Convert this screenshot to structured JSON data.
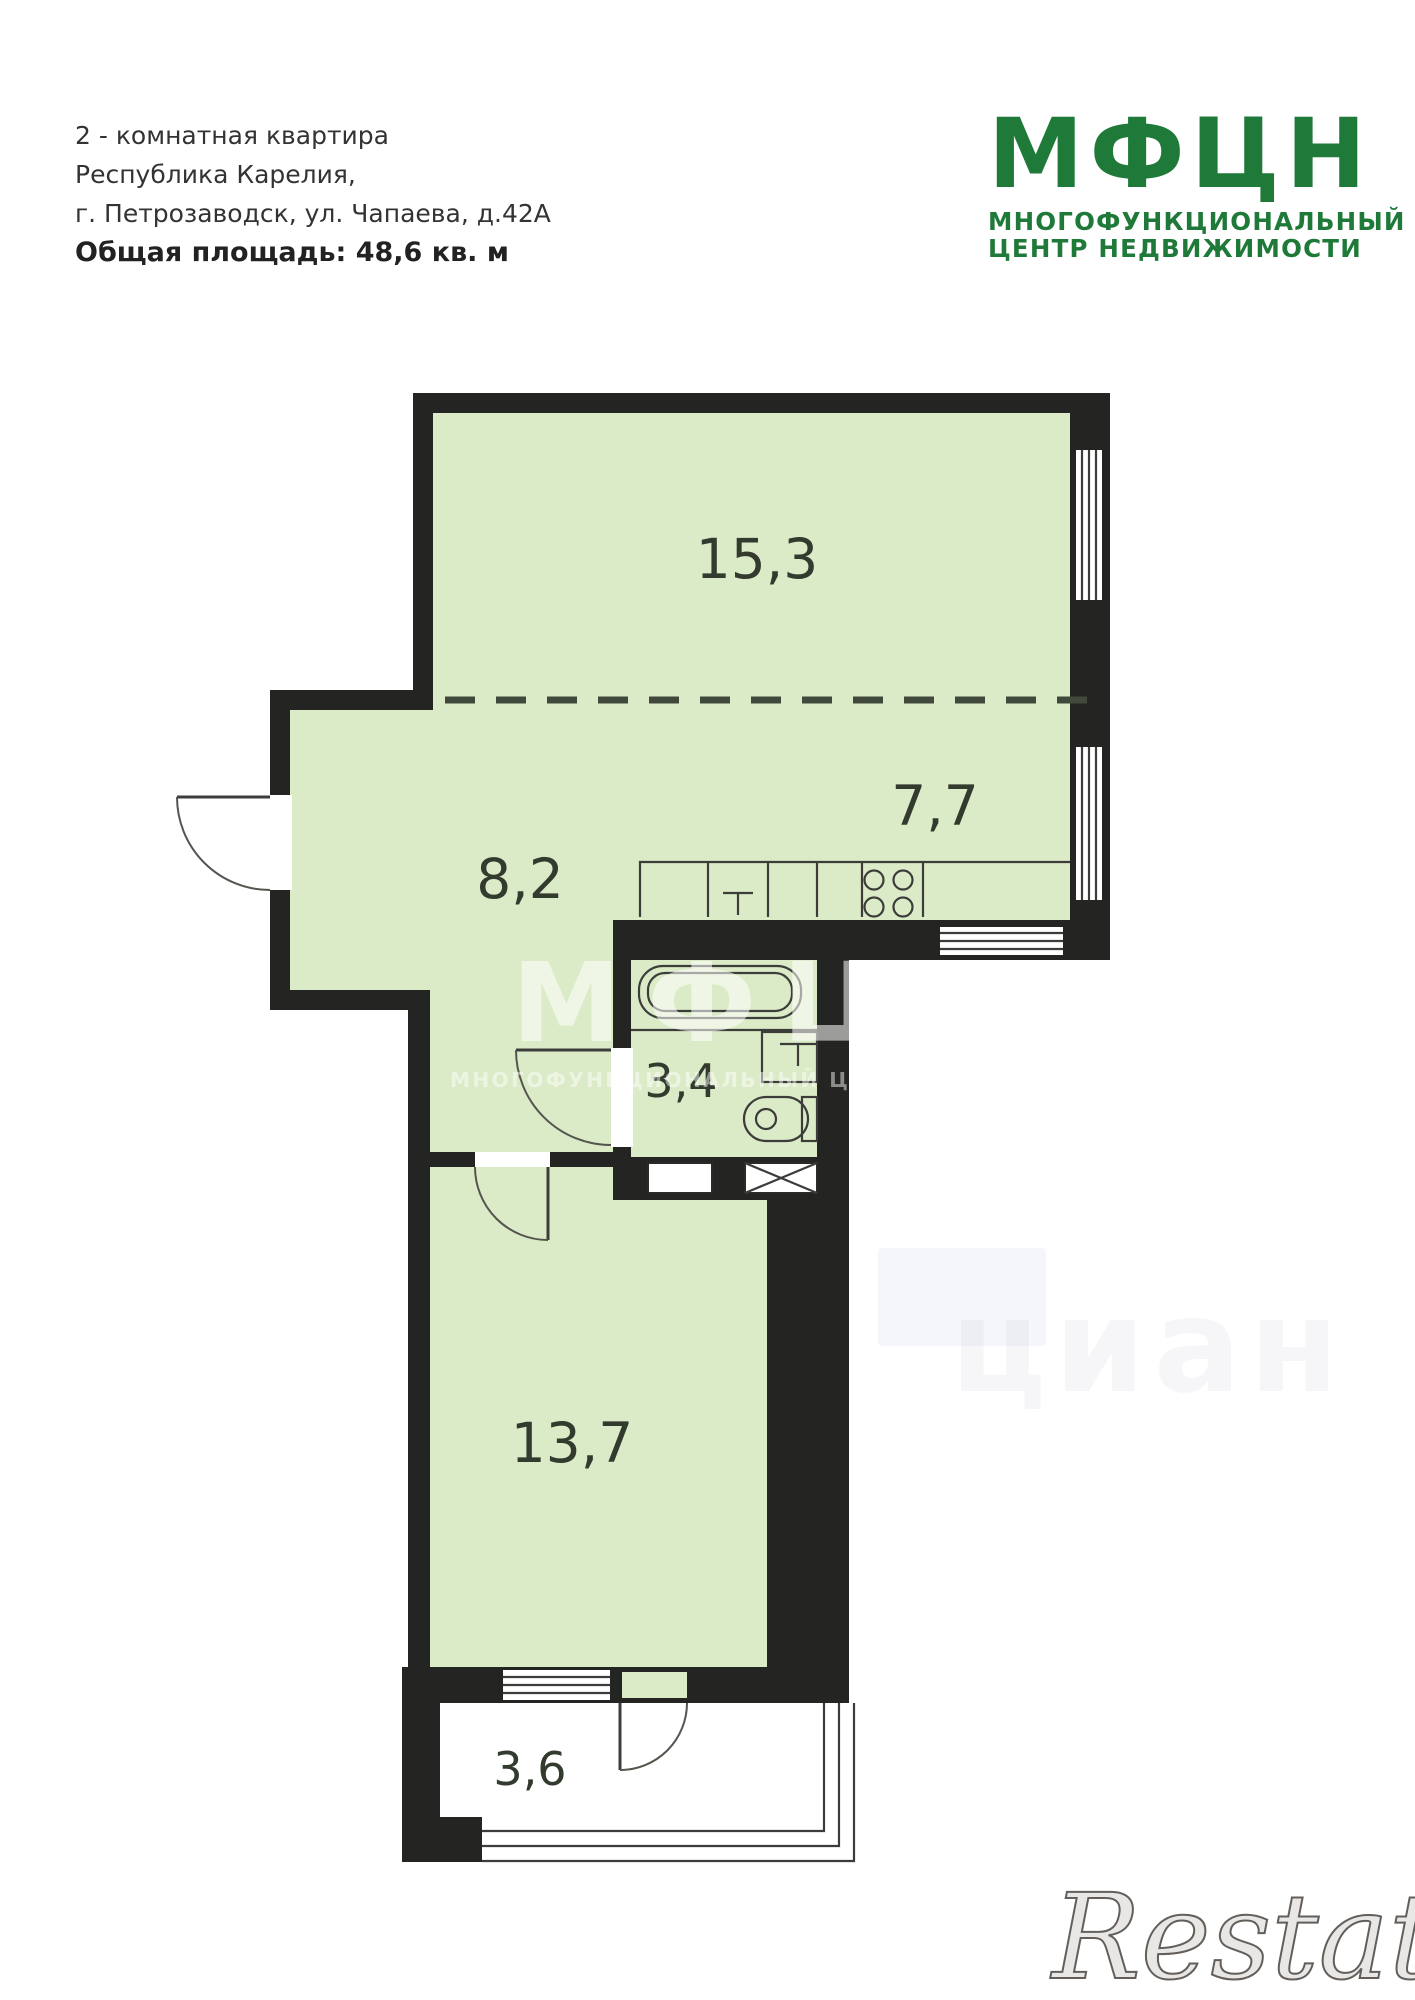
{
  "header": {
    "line1": "2 - комнатная квартира",
    "line2": "Республика Карелия,",
    "line3": "г. Петрозаводск, ул. Чапаева, д.42А",
    "area_line": "Общая площадь: 48,6 кв. м"
  },
  "logo": {
    "title": "МФЦН",
    "subtitle1": "МНОГОФУНКЦИОНАЛЬНЫЙ",
    "subtitle2": "ЦЕНТР НЕДВИЖИМОСТИ"
  },
  "plan": {
    "total_area_sqm": "48,6",
    "rooms": [
      {
        "id": "living-room",
        "area": "15,3"
      },
      {
        "id": "kitchen",
        "area": "7,7"
      },
      {
        "id": "hallway",
        "area": "8,2"
      },
      {
        "id": "bathroom",
        "area": "3,4"
      },
      {
        "id": "bedroom",
        "area": "13,7"
      },
      {
        "id": "balcony",
        "area": "3,6"
      }
    ]
  },
  "watermarks": {
    "center_title": "МФЦН",
    "center_subtitle": "МНОГОФУНКЦИОНАЛЬНЫЙ ЦЕНТР НЕДВИЖИМОСТИ",
    "corner_brand": "Restate",
    "faint_text": "циан"
  },
  "theme": {
    "wall": "#242422",
    "room": "#dcebc7",
    "line": "#3c3c3a",
    "label": "#333b2f",
    "logo": "#1f7a3a",
    "dash": "#40493c"
  }
}
